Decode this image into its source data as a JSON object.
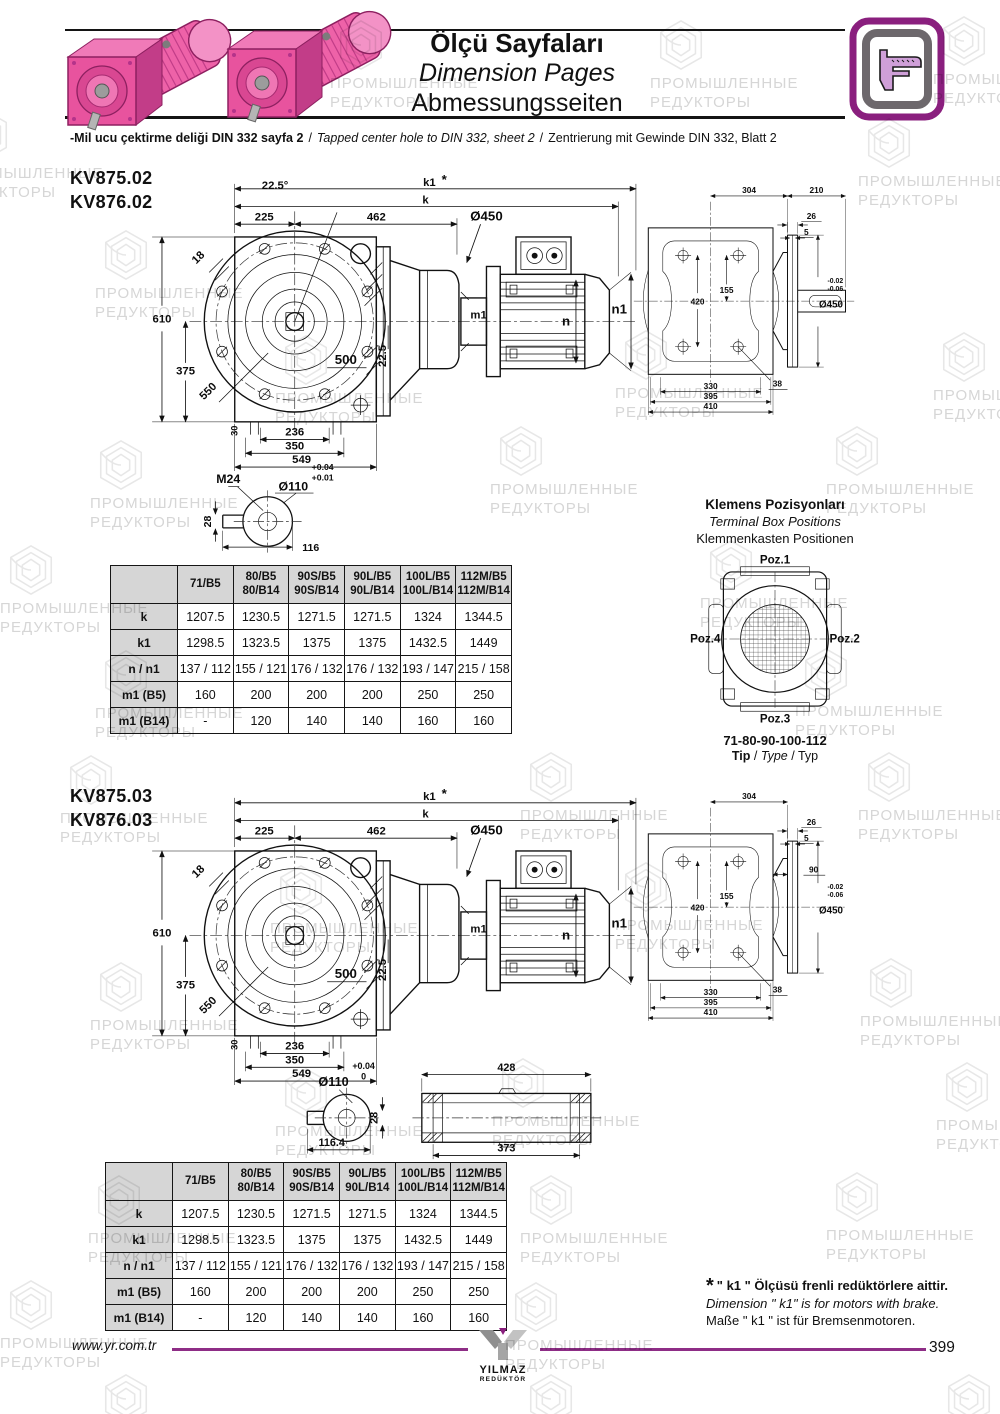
{
  "watermark": {
    "line1": "ПРОМЫШЛЕННЫЕ",
    "line2": "РЕДУКТОРЫ"
  },
  "header": {
    "title_tr": "Ölçü Sayfaları",
    "title_en": "Dimension Pages",
    "title_de": "Abmessungsseiten",
    "note_tr": "-Mil ucu çektirme deliği DIN 332 sayfa 2",
    "note_en": "Tapped center hole to DIN 332, sheet 2",
    "note_de": "Zentrierung mit Gewinde DIN 332, Blatt 2",
    "note_sep": "/"
  },
  "drawing1": {
    "model_a": "KV875.02",
    "model_b": "KV876.02",
    "front": {
      "angle": "22.5°",
      "k1": "k1",
      "star": "*",
      "k": "k",
      "w1": "225",
      "w2": "462",
      "flange_dia": "Ø450",
      "key": "18",
      "h1": "610",
      "h2": "375",
      "diag": "550",
      "circ": "500",
      "vert": "22.5",
      "foot": "30",
      "b1": "236",
      "b2": "350",
      "b3": "549",
      "m1": "m1",
      "n": "n",
      "n1": "n1"
    },
    "side": {
      "t1": "304",
      "t2": "210",
      "s1": "26",
      "s2": "5",
      "v1": "420",
      "v2": "155",
      "tol_u": "-0.02",
      "tol_l": "-0.06",
      "dia": "Ø450",
      "hole": "38",
      "b1": "330",
      "b2": "395",
      "b3": "410"
    },
    "shaft": {
      "thread": "M24",
      "tol_u": "+0.04",
      "tol_l": "+0.01",
      "dia": "Ø110",
      "w": "28",
      "len": "116"
    }
  },
  "drawing2": {
    "model_a": "KV875.03",
    "model_b": "KV876.03",
    "front": {
      "k1": "k1",
      "star": "*",
      "k": "k",
      "w1": "225",
      "w2": "462",
      "flange_dia": "Ø450",
      "key": "18",
      "h1": "610",
      "h2": "375",
      "diag": "550",
      "circ": "500",
      "vert": "22.5",
      "foot": "30",
      "b1": "236",
      "b2": "350",
      "b3": "549",
      "m1": "m1",
      "n": "n",
      "n1": "n1"
    },
    "side": {
      "t1": "304",
      "s1": "26",
      "s2": "5",
      "v1": "420",
      "v2": "155",
      "mid": "90",
      "tol_u": "-0.02",
      "tol_l": "-0.06",
      "dia": "Ø450",
      "hole": "38",
      "b1": "330",
      "b2": "395",
      "b3": "410"
    },
    "shaft": {
      "tol_u": "+0.04",
      "tol_l": "0",
      "dia": "Ø110",
      "w": "28",
      "len": "116.4"
    },
    "hollow": {
      "outer": "428",
      "inner": "373"
    }
  },
  "dim_table": {
    "col_headers": [
      "71/B5",
      "80/B5\n80/B14",
      "90S/B5\n90S/B14",
      "90L/B5\n90L/B14",
      "100L/B5\n100L/B14",
      "112M/B5\n112M/B14"
    ],
    "rows": [
      {
        "label": "k",
        "values": [
          "1207.5",
          "1230.5",
          "1271.5",
          "1271.5",
          "1324",
          "1344.5"
        ]
      },
      {
        "label": "k1",
        "values": [
          "1298.5",
          "1323.5",
          "1375",
          "1375",
          "1432.5",
          "1449"
        ]
      },
      {
        "label": "n / n1",
        "values": [
          "137 / 112",
          "155 / 121",
          "176 / 132",
          "176 / 132",
          "193 / 147",
          "215 / 158"
        ]
      },
      {
        "label": "m1 (B5)",
        "values": [
          "160",
          "200",
          "200",
          "200",
          "250",
          "250"
        ]
      },
      {
        "label": "m1 (B14)",
        "values": [
          "-",
          "120",
          "140",
          "140",
          "160",
          "160"
        ]
      }
    ]
  },
  "terminal_box": {
    "title_tr": "Klemens Pozisyonları",
    "title_en": "Terminal Box Positions",
    "title_de": "Klemmenkasten Positionen",
    "poz1": "Poz.1",
    "poz2": "Poz.2",
    "poz3": "Poz.3",
    "poz4": "Poz.4",
    "sizes": "71-80-90-100-112",
    "tip": "Tip",
    "type": "Type",
    "typ": "Typ",
    "tip_sep": "/"
  },
  "footnote": {
    "star": "*",
    "tr": "\" k1 \" Ölçüsü frenli redüktörlere aittir.",
    "en": "Dimension \" k1\" is for motors with brake.",
    "de": "Maße \" k1 \" ist für Bremsenmotoren."
  },
  "footer": {
    "url": "www.yr.com.tr",
    "logo_top": "YILMAZ",
    "logo_bottom": "REDÜKTÖR",
    "page": "399"
  }
}
